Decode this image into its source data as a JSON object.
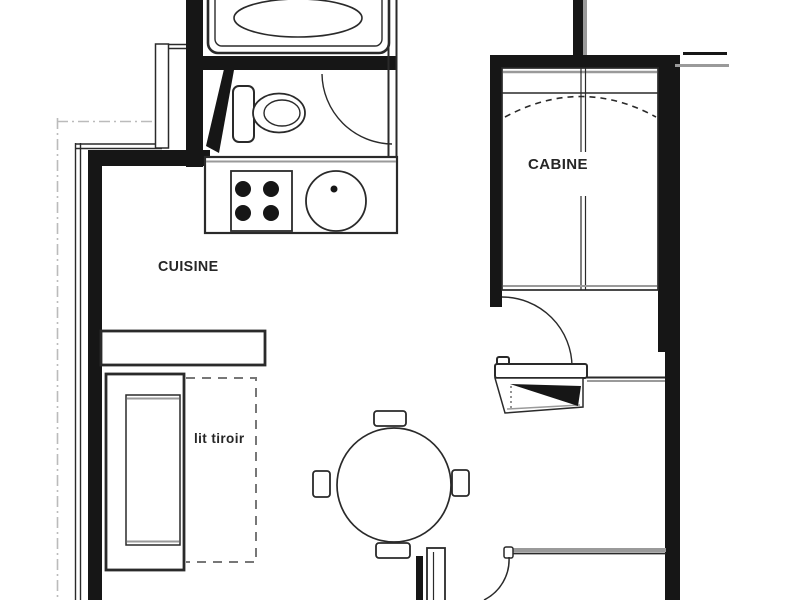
{
  "plan": {
    "type": "apartment-floor-plan",
    "labels": {
      "kitchen": "CUISINE",
      "cabin": "CABINE",
      "pullout_bed": "lit tiroir"
    },
    "rooms": [
      "CUISINE",
      "CABINE"
    ],
    "furniture": [
      "bathtub",
      "toilet",
      "stove-4-burners",
      "round-sink",
      "kitchen-counter",
      "bunk-cabin-beds",
      "entry-storage",
      "round-dining-table",
      "four-chairs",
      "sofa",
      "wall-shelf",
      "pull-out-bed"
    ],
    "colors": {
      "wall": "#161616",
      "line": "#2a2a2a",
      "gray": "#9a9a9a",
      "faint": "#bbbbbb",
      "bg": "#ffffff"
    }
  }
}
